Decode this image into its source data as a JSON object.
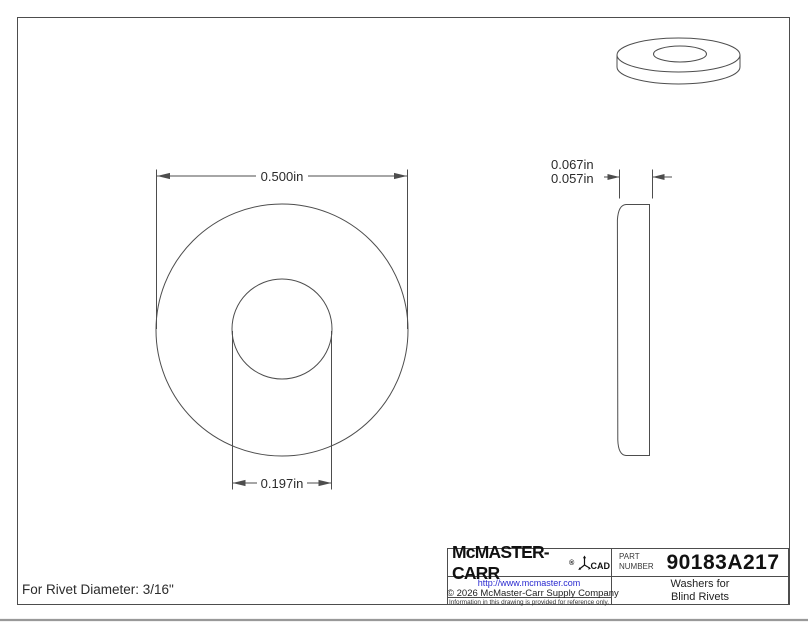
{
  "note": "For Rivet Diameter: 3/16\"",
  "dimensions": {
    "outer_diameter": "0.500in",
    "hole_diameter": "0.197in",
    "thickness_max": "0.067in",
    "thickness_min": "0.057in"
  },
  "title_block": {
    "brand": "McMASTER-CARR",
    "registered": "®",
    "cad_label": "CAD",
    "part_label_line1": "PART",
    "part_label_line2": "NUMBER",
    "part_number": "90183A217",
    "description_line1": "Washers for",
    "description_line2": "Blind Rivets",
    "url": "http://www.mcmaster.com",
    "copyright": "© 2026 McMaster-Carr Supply Company",
    "disclaimer": "Information in this drawing is provided for reference only."
  },
  "colors": {
    "line": "#4d4d4d",
    "link": "#2a2ad0",
    "bottom_rule": "#999999"
  }
}
